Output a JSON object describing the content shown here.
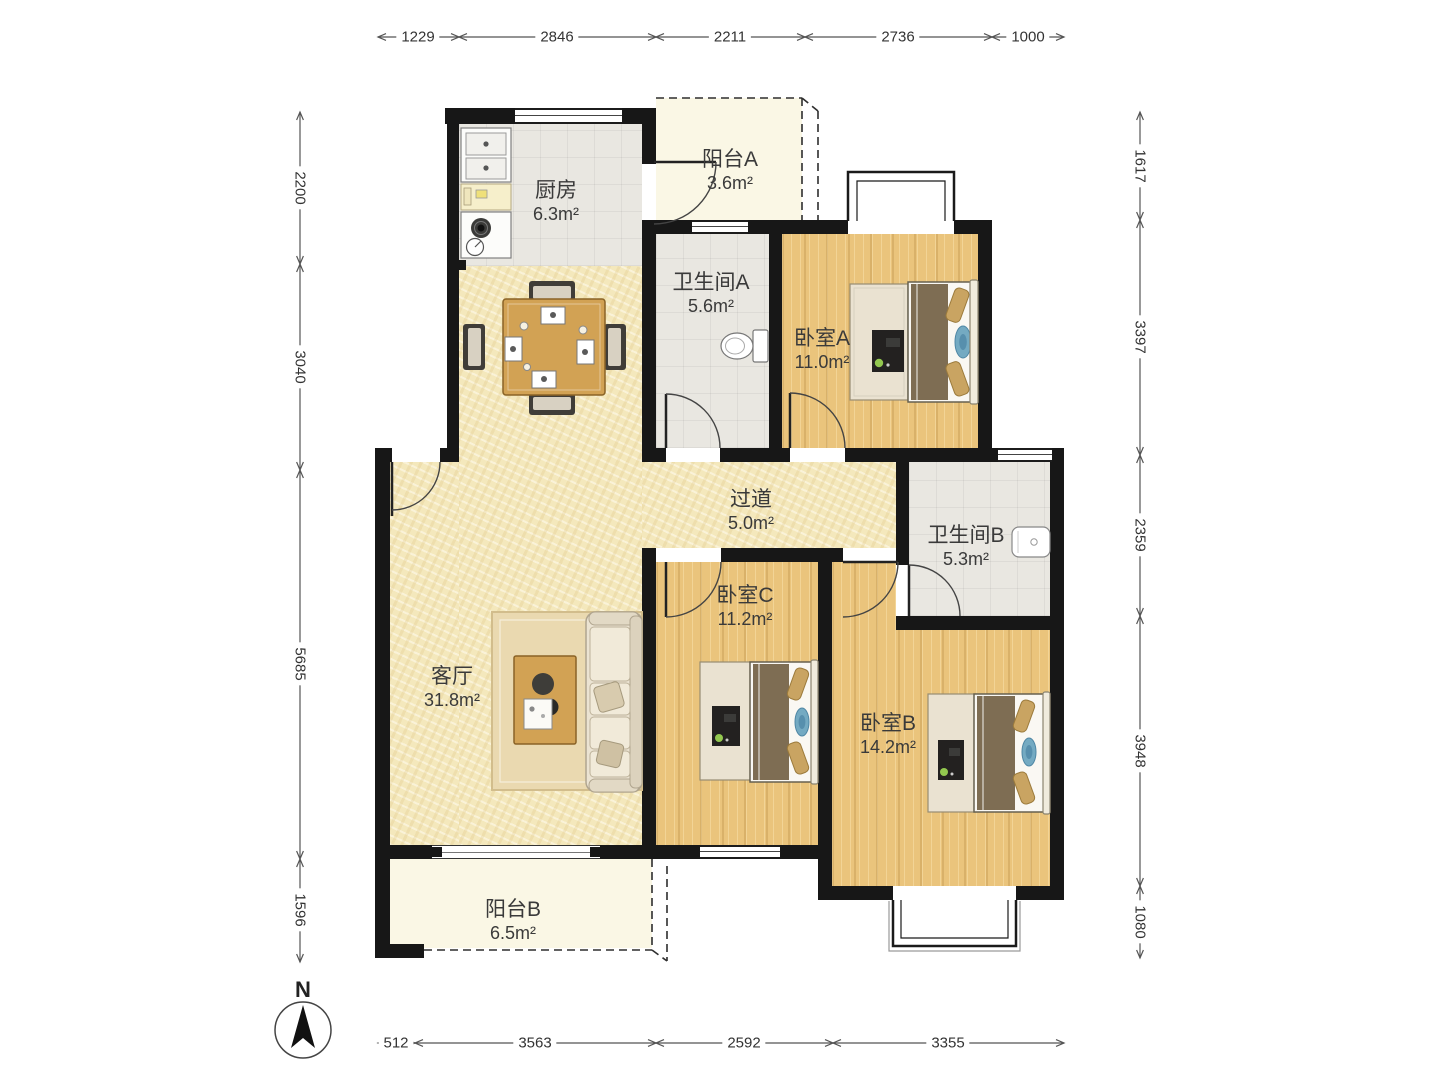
{
  "title": "三室两厅户型图",
  "compass": {
    "label": "N"
  },
  "rooms": {
    "kitchen": {
      "name": "厨房",
      "area": "6.3m²"
    },
    "balcony_a": {
      "name": "阳台A",
      "area": "3.6m²"
    },
    "bath_a": {
      "name": "卫生间A",
      "area": "5.6m²"
    },
    "bed_a": {
      "name": "卧室A",
      "area": "11.0m²"
    },
    "corridor": {
      "name": "过道",
      "area": "5.0m²"
    },
    "bath_b": {
      "name": "卫生间B",
      "area": "5.3m²"
    },
    "living": {
      "name": "客厅",
      "area": "31.8m²"
    },
    "bed_c": {
      "name": "卧室C",
      "area": "11.2m²"
    },
    "bed_b": {
      "name": "卧室B",
      "area": "14.2m²"
    },
    "balcony_b": {
      "name": "阳台B",
      "area": "6.5m²"
    }
  },
  "dimensions": {
    "top": [
      "1229",
      "2846",
      "2211",
      "2736",
      "1000"
    ],
    "left": [
      "2200",
      "3040",
      "5685",
      "1596"
    ],
    "right": [
      "1617",
      "3397",
      "2359",
      "3948",
      "1080"
    ],
    "bottom": [
      "512",
      "3563",
      "2592",
      "3355"
    ]
  },
  "colors": {
    "wall": "#171717",
    "wood_floor": "#eac47c",
    "tile_floor": "#e9e7e1",
    "living_floor": "#f4e8bc",
    "balcony_floor": "#faf7e5",
    "bed_duvet": "#7e6d53",
    "pillow": "#c9a462",
    "accent_blue": "#74aac2",
    "furniture_wood": "#d2a254"
  }
}
